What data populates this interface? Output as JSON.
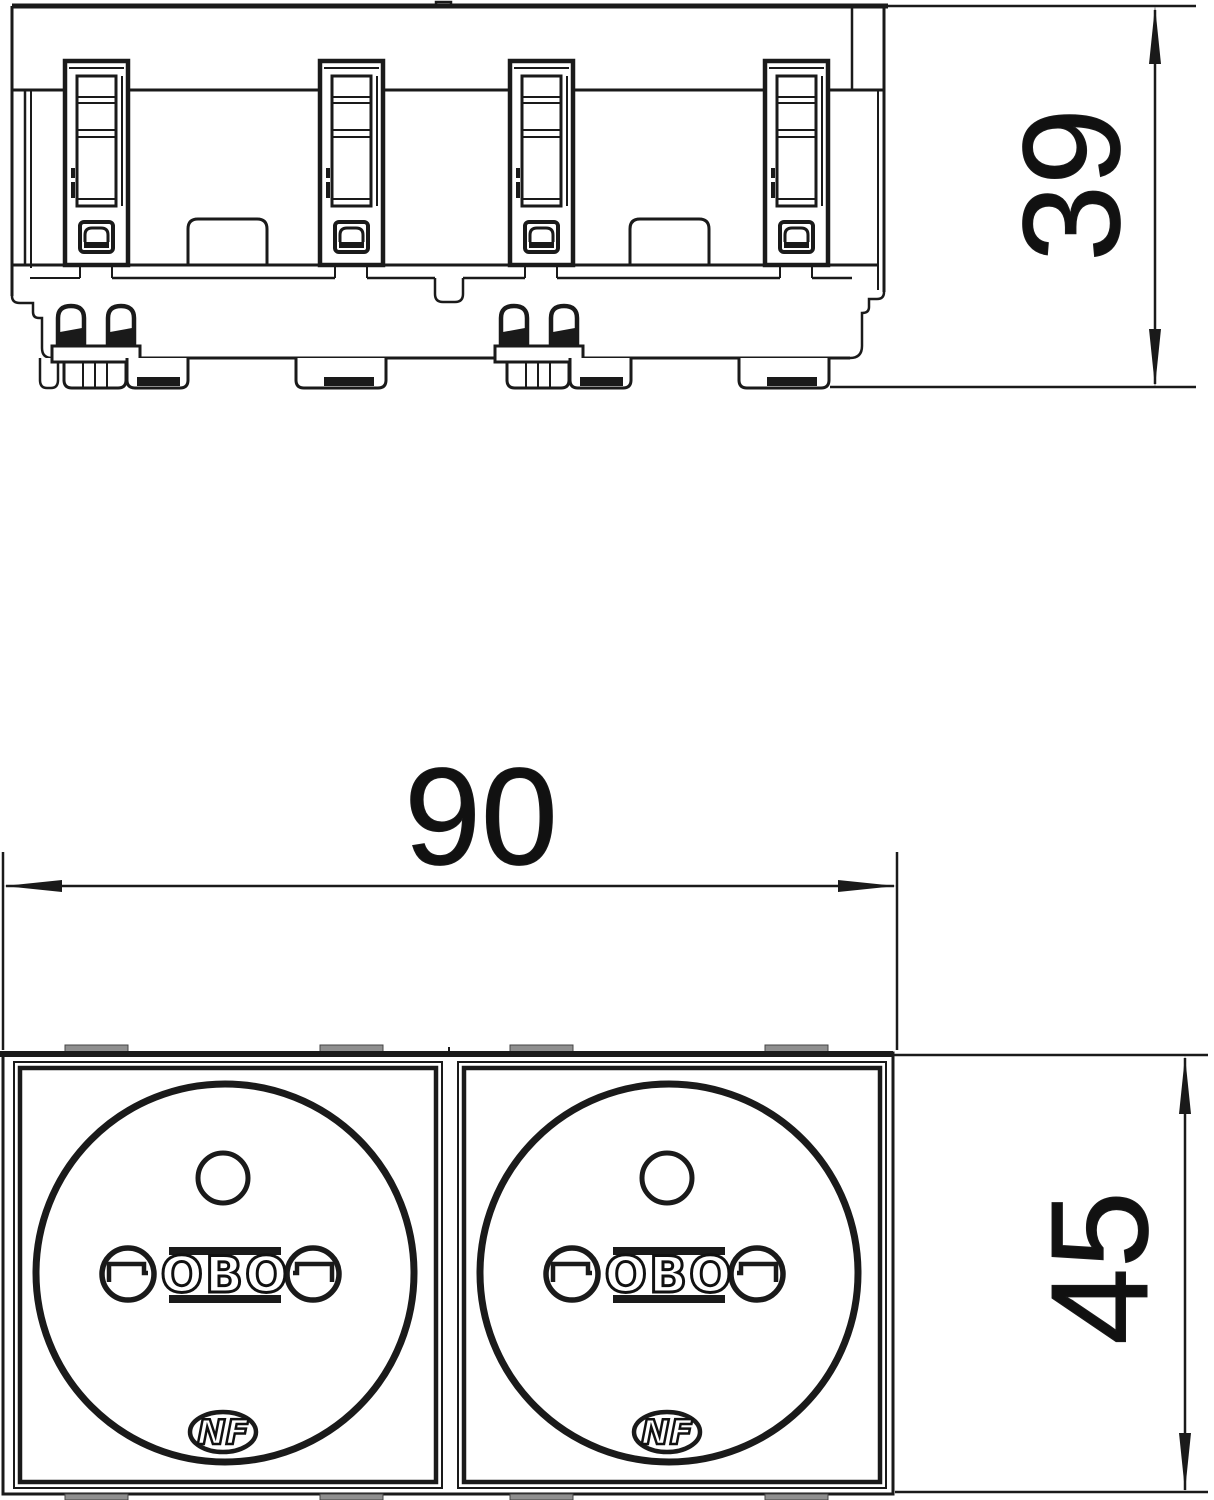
{
  "drawing": {
    "kind": "technical-dimension-drawing",
    "dimensions": {
      "side_height": "39",
      "front_width": "90",
      "front_height": "45"
    },
    "logos": {
      "brand": "OBO",
      "certification": "NF"
    },
    "colors": {
      "line": "#1a1a1a",
      "clip_gray": "#8f8f8f",
      "background": "#ffffff"
    }
  }
}
